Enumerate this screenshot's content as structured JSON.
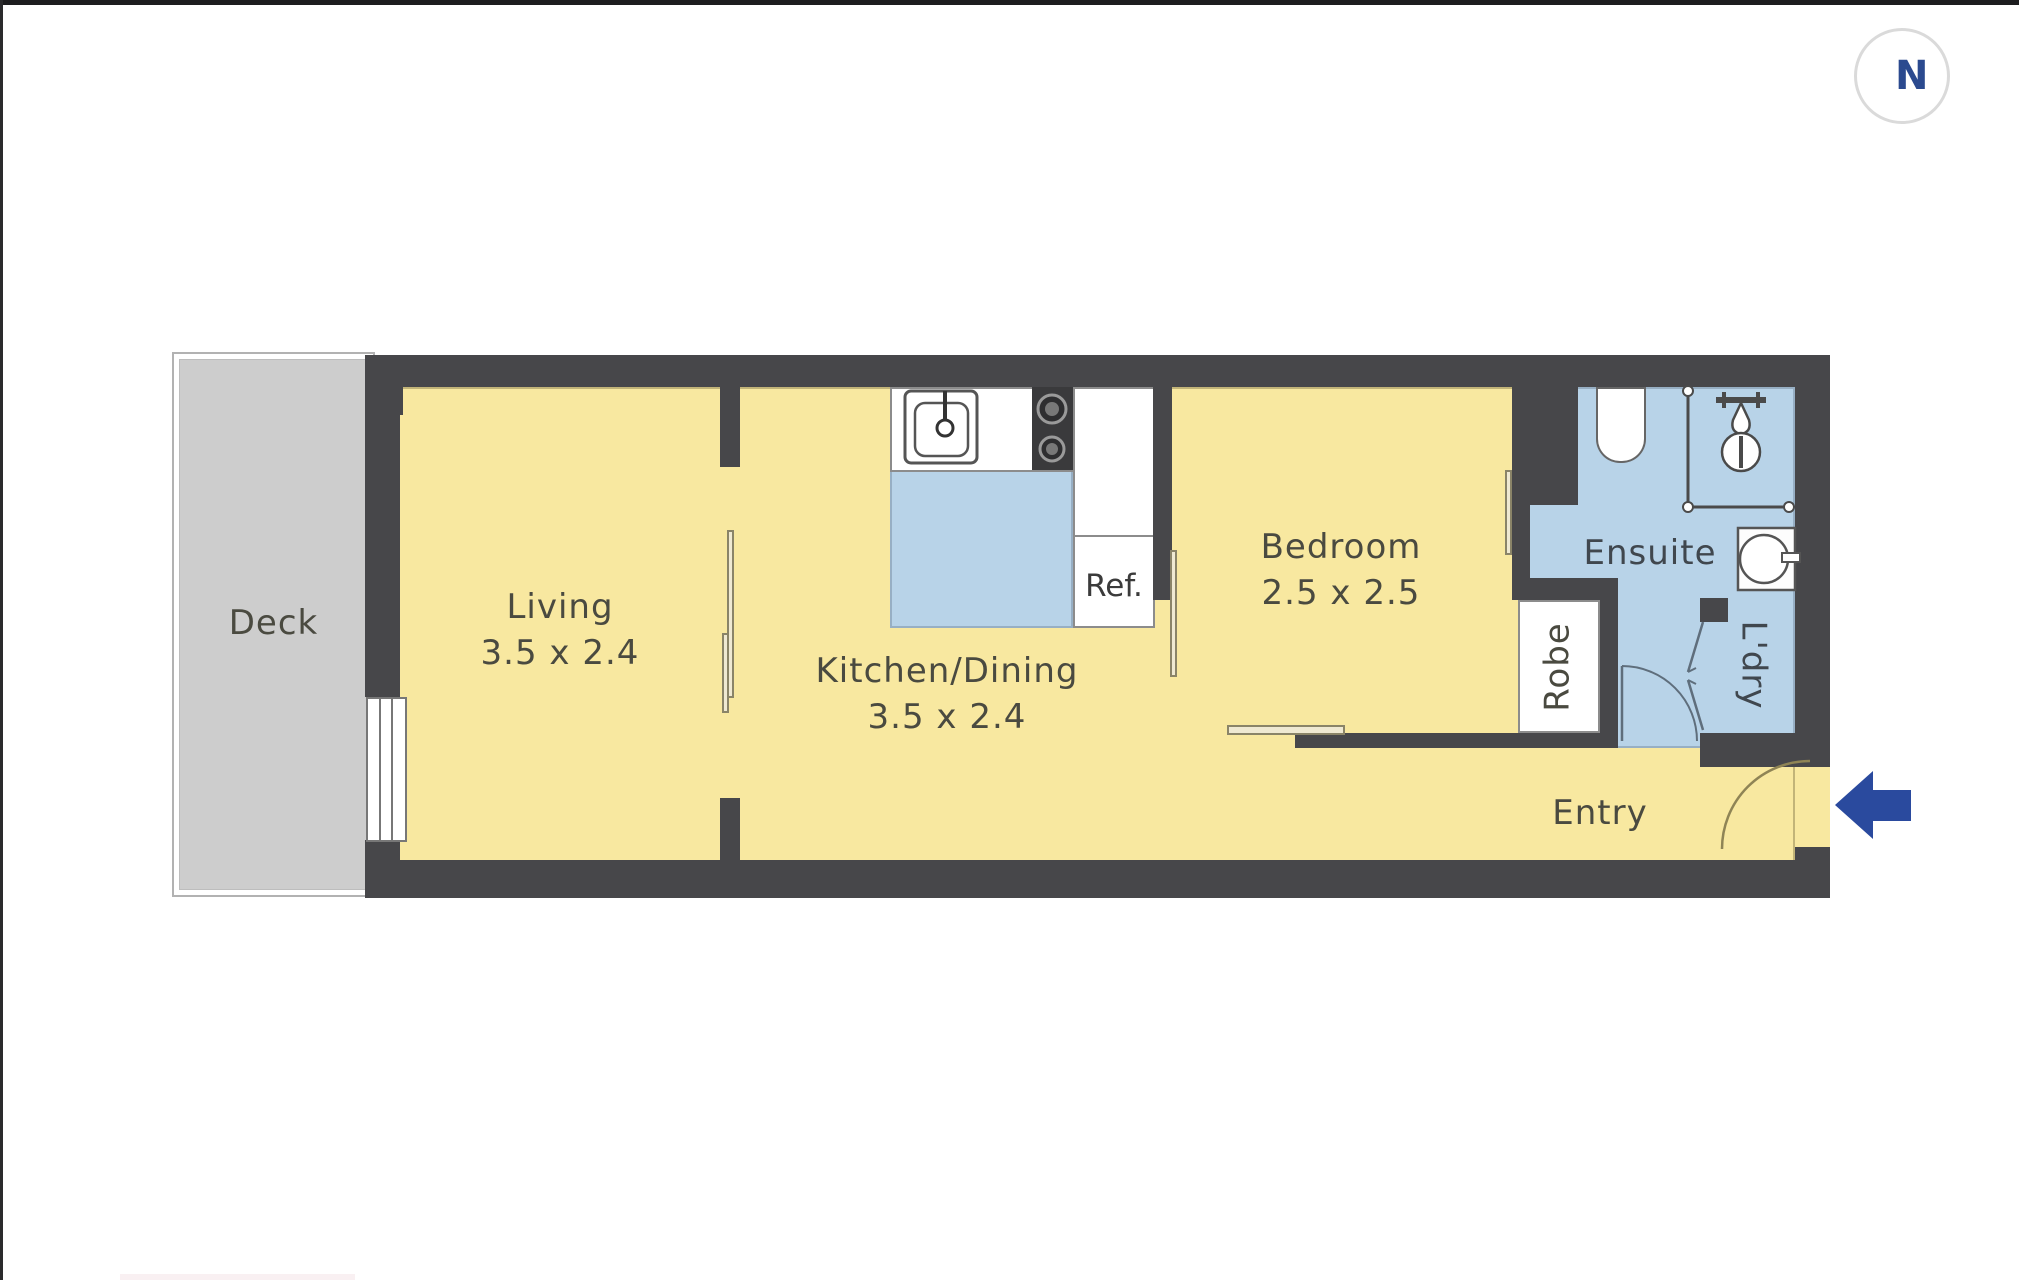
{
  "compass": {
    "label": "N"
  },
  "rooms": {
    "deck": {
      "label": "Deck"
    },
    "living": {
      "label": "Living",
      "dimensions": "3.5 x 2.4"
    },
    "kitchen_dining": {
      "label": "Kitchen/Dining",
      "dimensions": "3.5 x 2.4"
    },
    "bedroom": {
      "label": "Bedroom",
      "dimensions": "2.5 x 2.5"
    },
    "ensuite": {
      "label": "Ensuite"
    },
    "robe": {
      "label": "Robe"
    },
    "laundry": {
      "label": "L'dry"
    },
    "entry": {
      "label": "Entry"
    }
  },
  "fixtures": {
    "refrigerator": {
      "label": "Ref."
    }
  },
  "colors": {
    "wall": "#47474a",
    "floor_yellow": "#f8e8a0",
    "wet_area_blue": "#b8d3e8",
    "deck_gray": "#cdcdcd",
    "accent_blue": "#2a4a9e",
    "compass_text": "#2b4a8f"
  }
}
